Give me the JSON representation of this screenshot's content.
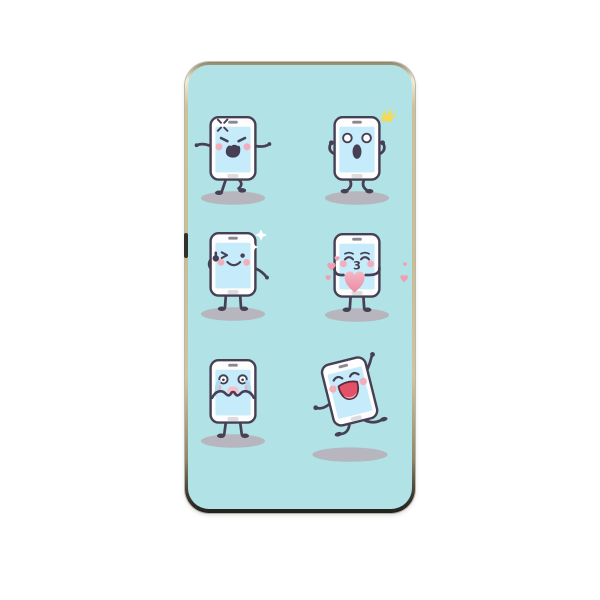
{
  "product": {
    "kind": "phone case back cover",
    "frame_material": "gold metallic",
    "print_theme": "cartoon smartphone emoji characters",
    "grid": "2 columns x 3 rows"
  },
  "colors": {
    "page_background": "#ffffff",
    "print_background": "#b0e2e6",
    "outline": "#474054",
    "phone_body": "#fdfdfe",
    "screen": "#c6ebfa",
    "speaker": "#8d8795",
    "home_button": "#dcdcde",
    "cheek": "#f2aebc",
    "shadow": "#b7b6be",
    "tear": "#a9dbf2",
    "cry_mouth": "#f8bfcb",
    "heart_light": "#f6b7c5",
    "heart_mid": "#f09fb2",
    "heart_dark": "#ea8aa1",
    "laugh_red": "#e25168",
    "laugh_outline": "#5d2c3e",
    "tongue": "#f4a8b8",
    "sparkle_white": "#ffffff",
    "accent_yellow": "#f0db58",
    "frame_gold_light": "#f3ecd6",
    "frame_gold": "#c9bd92",
    "frame_dark": "#22211c",
    "side_button": "#32302b"
  },
  "characters": [
    {
      "id": "angry",
      "label": "angry phone with anger mark, walking",
      "row": 1,
      "col": 1
    },
    {
      "id": "surprised",
      "label": "surprised phone with yellow startle crown",
      "row": 1,
      "col": 2
    },
    {
      "id": "winking",
      "label": "winking phone giving thumbs up with sparkles",
      "row": 2,
      "col": 1
    },
    {
      "id": "kissing",
      "label": "kissing phone hugging a pink heart",
      "mouth_label": "3",
      "row": 2,
      "col": 2
    },
    {
      "id": "crying",
      "label": "crying phone with streaming tears, hands over mouth",
      "row": 3,
      "col": 1
    },
    {
      "id": "dancing",
      "label": "laughing phone dancing with arm raised",
      "row": 3,
      "col": 2
    }
  ]
}
